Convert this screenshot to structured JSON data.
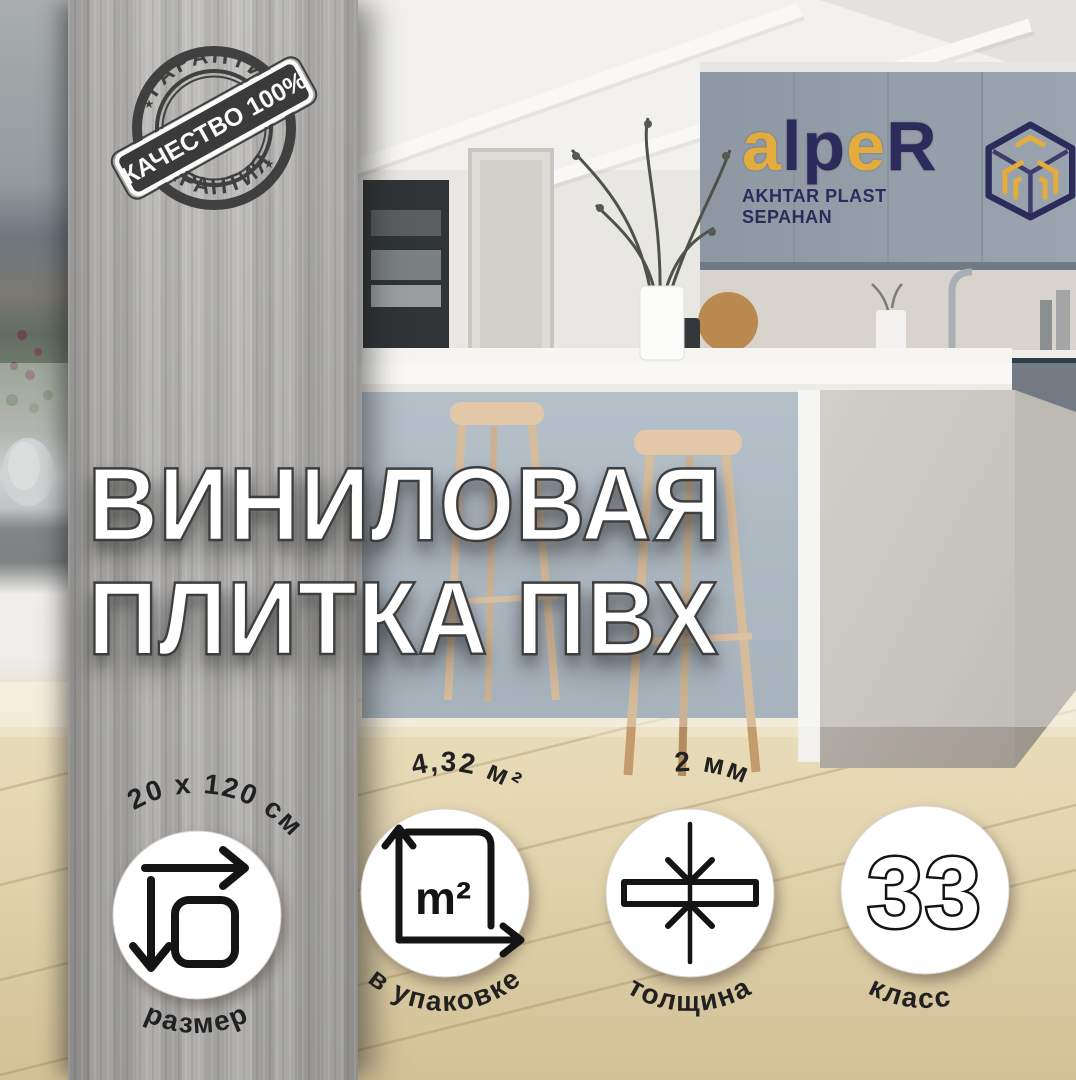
{
  "stamp": {
    "arc_top": "ГАРАНТИЯ",
    "arc_bottom": "ГАРАНТИЯ",
    "banner": "КАЧЕСТВО 100%",
    "star": "★"
  },
  "logo": {
    "letters": [
      {
        "ch": "a",
        "color": "#E3AC3C"
      },
      {
        "ch": "l",
        "color": "#2B2C5C"
      },
      {
        "ch": "p",
        "color": "#2B2C5C"
      },
      {
        "ch": "e",
        "color": "#E3AC3C"
      },
      {
        "ch": "R",
        "color": "#2B2C5C"
      }
    ],
    "subtitle": "AKHTAR PLAST SEPAHAN"
  },
  "title": {
    "line1": "ВИНИЛОВАЯ",
    "line2": "ПЛИТКА ПВХ"
  },
  "badges": [
    {
      "icon": "dimensions-icon",
      "top": "20 x 120 см",
      "bottom": "размер"
    },
    {
      "icon": "area-icon",
      "icon_label": "m²",
      "top": "4,32 м²",
      "bottom": "в упаковке"
    },
    {
      "icon": "thickness-icon",
      "top": "2 мм",
      "bottom": "толщина"
    },
    {
      "icon": "class-number",
      "center": "33",
      "bottom": "класс"
    }
  ],
  "colors": {
    "brand_navy": "#2B2C5C",
    "brand_gold": "#E3AC3C",
    "stamp_ink": "#3A3A3A",
    "badge_ink": "#1D1D1D"
  }
}
